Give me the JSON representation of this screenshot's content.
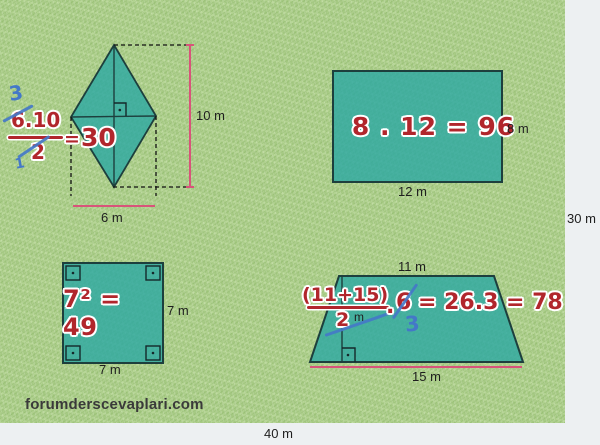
{
  "watermark": "forumderscevaplari.com",
  "field": {
    "right_label": "30 m",
    "bottom_label": "40 m"
  },
  "kite": {
    "formula": {
      "cancel_top": "3",
      "numerator": "6.10",
      "denominator": "2",
      "cancel_bottom": "1",
      "equals": "=",
      "result": "30"
    },
    "labels": {
      "vertical_diagonal": "10 m",
      "horizontal_diagonal": "6 m"
    }
  },
  "rectangle": {
    "formula": "8 . 12 = 96",
    "labels": {
      "right": "8 m",
      "bottom": "12 m"
    }
  },
  "square": {
    "formula": "7² = 49",
    "labels": {
      "right": "7 m",
      "bottom": "7 m"
    }
  },
  "trapezoid": {
    "formula": {
      "numerator": "(11+15)",
      "denominator": "2",
      "height_unit": "m",
      "dot": ".",
      "multiplier": "6",
      "cancel": "3",
      "result": "= 26.3 = 78"
    },
    "labels": {
      "top": "11 m",
      "bottom": "15 m"
    }
  },
  "colors": {
    "formula_red": "#b1262c",
    "annotation_blue": "#4478c8",
    "measure_pink": "#d8547a",
    "shape_teal": "#49b5b1",
    "grass_green": "#aecf8d"
  }
}
